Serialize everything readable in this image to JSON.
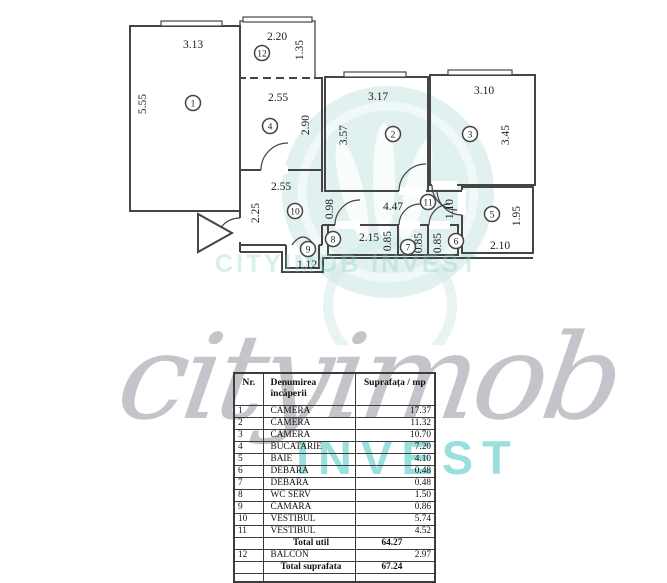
{
  "colors": {
    "wall": "#454545",
    "accent_teal": "#46c5c1",
    "watermark_gray": "#7d7d8a",
    "watermark_circle": "#dcefed"
  },
  "watermark": {
    "script": "cityimob",
    "invest": "INVEST",
    "ghost": "CITYIMOB INVEST"
  },
  "plan": {
    "rooms": [
      {
        "num": "1"
      },
      {
        "num": "12"
      },
      {
        "num": "4"
      },
      {
        "num": "2"
      },
      {
        "num": "3"
      },
      {
        "num": "10"
      },
      {
        "num": "11"
      },
      {
        "num": "5"
      },
      {
        "num": "8"
      },
      {
        "num": "7"
      },
      {
        "num": "6"
      },
      {
        "num": "9"
      }
    ],
    "dims": [
      {
        "t": "3.13"
      },
      {
        "t": "5.55"
      },
      {
        "t": "2.20"
      },
      {
        "t": "1.35"
      },
      {
        "t": "2.55"
      },
      {
        "t": "2.90"
      },
      {
        "t": "3.17"
      },
      {
        "t": "3.57"
      },
      {
        "t": "3.10"
      },
      {
        "t": "3.45"
      },
      {
        "t": "2.55"
      },
      {
        "t": "2.25"
      },
      {
        "t": "0.98"
      },
      {
        "t": "4.47"
      },
      {
        "t": "1.10"
      },
      {
        "t": "2.15"
      },
      {
        "t": "0.85"
      },
      {
        "t": "0.85"
      },
      {
        "t": "0.85"
      },
      {
        "t": "2.10"
      },
      {
        "t": "1.95"
      },
      {
        "t": "1.12"
      }
    ]
  },
  "table": {
    "headers": [
      "Nr.",
      "Denumirea încăperii",
      "Suprafața / mp"
    ],
    "rows": [
      [
        "1",
        "CAMERA",
        "17.37"
      ],
      [
        "2",
        "CAMERA",
        "11.32"
      ],
      [
        "3",
        "CAMERA",
        "10.70"
      ],
      [
        "4",
        "BUCATARIE",
        "7.20"
      ],
      [
        "5",
        "BAIE",
        "4.10"
      ],
      [
        "6",
        "DEBARA",
        "0.48"
      ],
      [
        "7",
        "DEBARA",
        "0.48"
      ],
      [
        "8",
        "WC SERV",
        "1.50"
      ],
      [
        "9",
        "CAMARA",
        "0.86"
      ],
      [
        "10",
        "VESTIBUL",
        "5.74"
      ],
      [
        "11",
        "VESTIBUL",
        "4.52"
      ]
    ],
    "total_util": {
      "label": "Total util",
      "value": "64.27"
    },
    "balcon_row": [
      "12",
      "BALCON",
      "2.97"
    ],
    "total_suprafata": {
      "label": "Total suprafata",
      "value": "67.24"
    }
  }
}
